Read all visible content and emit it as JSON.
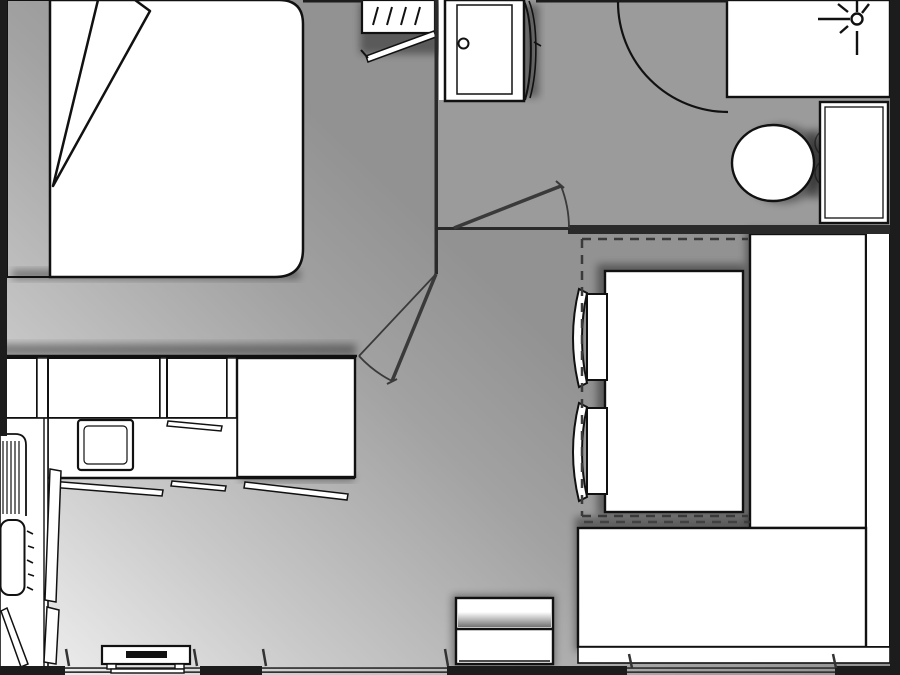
{
  "meta": {
    "title": "Mobile home floor plan",
    "view": "top-down architectural plan",
    "canvas_width": 900,
    "canvas_height": 675
  },
  "colors": {
    "wall": "#1c1c1c",
    "wall_inner": "#2a2a2a",
    "outline": "#111111",
    "furniture": "#ffffff",
    "floor_light": "#f0f0f0",
    "floor_mid": "#c9c9c9",
    "floor_dark": "#929292",
    "floor_bath": "#9c9c9c",
    "door_swing": "#3a3a3a",
    "window_frame": "#333333",
    "tv_screen": "#111111",
    "headboard_shade": "#d5d5d5"
  },
  "rooms": {
    "bedroom": {
      "label": "Bedroom"
    },
    "hallway": {
      "label": "Hallway"
    },
    "bathroom": {
      "label": "Bathroom / WC"
    },
    "kitchen": {
      "label": "Kitchen"
    },
    "dinette": {
      "label": "Dining area"
    },
    "living": {
      "label": "Living area"
    }
  },
  "furniture": {
    "bed": {
      "label": "Double bed"
    },
    "headboard": {
      "label": "Headboard shelf"
    },
    "duvet_fold": {
      "label": "Folded duvet corner"
    },
    "wardrobe": {
      "label": "Wardrobe with open door"
    },
    "shower": {
      "label": "Shower cubicle with drain"
    },
    "shower_door": {
      "label": "Curved shower door"
    },
    "vanity": {
      "label": "Washbasin counter"
    },
    "tap": {
      "label": "Tap symbol"
    },
    "toilet": {
      "label": "Toilet with cistern"
    },
    "bathroom_door": {
      "label": "Bathroom door swing"
    },
    "bedroom_door": {
      "label": "Bedroom door swing"
    },
    "entrance_swing": {
      "label": "Entrance door swing arc"
    },
    "table": {
      "label": "Dining table"
    },
    "chair_top": {
      "label": "Dining chair"
    },
    "chair_bottom": {
      "label": "Dining chair"
    },
    "bench_right": {
      "label": "Bench seat (right)"
    },
    "bench_bottom": {
      "label": "Bench seat (bottom)"
    },
    "bench_backrest": {
      "label": "Bench backrest"
    },
    "storage_cabinet": {
      "label": "Storage cabinet"
    },
    "kitchen_unit_a": {
      "label": "Kitchen base unit"
    },
    "kitchen_unit_b": {
      "label": "Kitchen base unit"
    },
    "kitchen_unit_c": {
      "label": "Kitchen base unit"
    },
    "tall_unit": {
      "label": "Tall unit / refrigerator"
    },
    "worktop": {
      "label": "Kitchen worktop"
    },
    "hob": {
      "label": "Hob / sink module"
    },
    "sink": {
      "label": "Kitchen sink"
    },
    "draining_board": {
      "label": "Draining board"
    },
    "open_door": {
      "label": "Open cabinet door"
    },
    "tv_unit": {
      "label": "TV / media unit"
    },
    "window": {
      "label": "Window"
    },
    "dinette_outline": {
      "label": "Dinette dashed outline"
    }
  }
}
